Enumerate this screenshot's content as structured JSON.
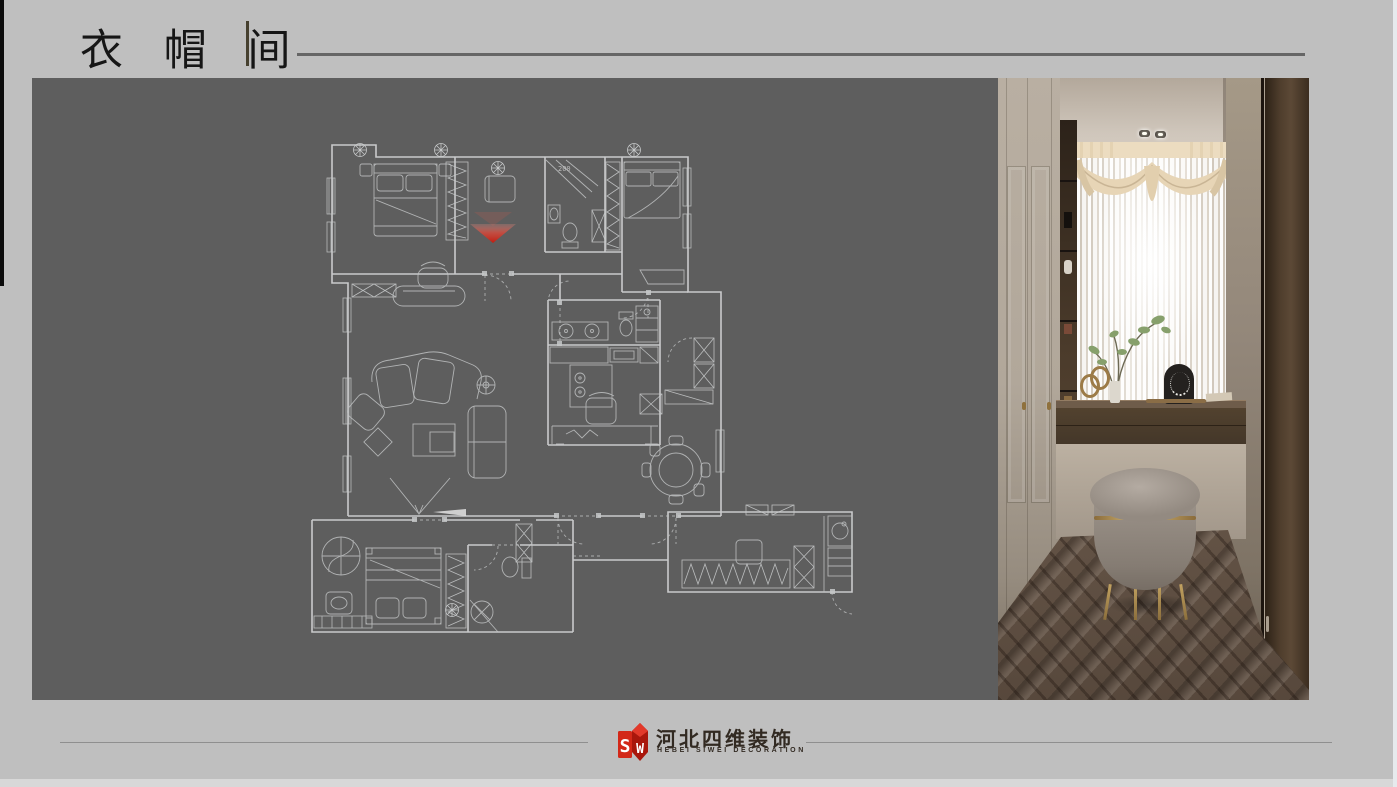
{
  "header": {
    "title": "衣 帽 间"
  },
  "plan": {
    "annotation": "200"
  },
  "footer": {
    "company_cn": "河北四维装饰",
    "company_en": "HEBEI SIWEI DECORATION",
    "logo_s": "S",
    "logo_w": "W"
  },
  "colors": {
    "background": "#bfbfbf",
    "panel_gray": "#5e5e5e",
    "accent_red": "#cf2418",
    "plan_line": "#cdced0",
    "rule_gray": "#666666"
  }
}
